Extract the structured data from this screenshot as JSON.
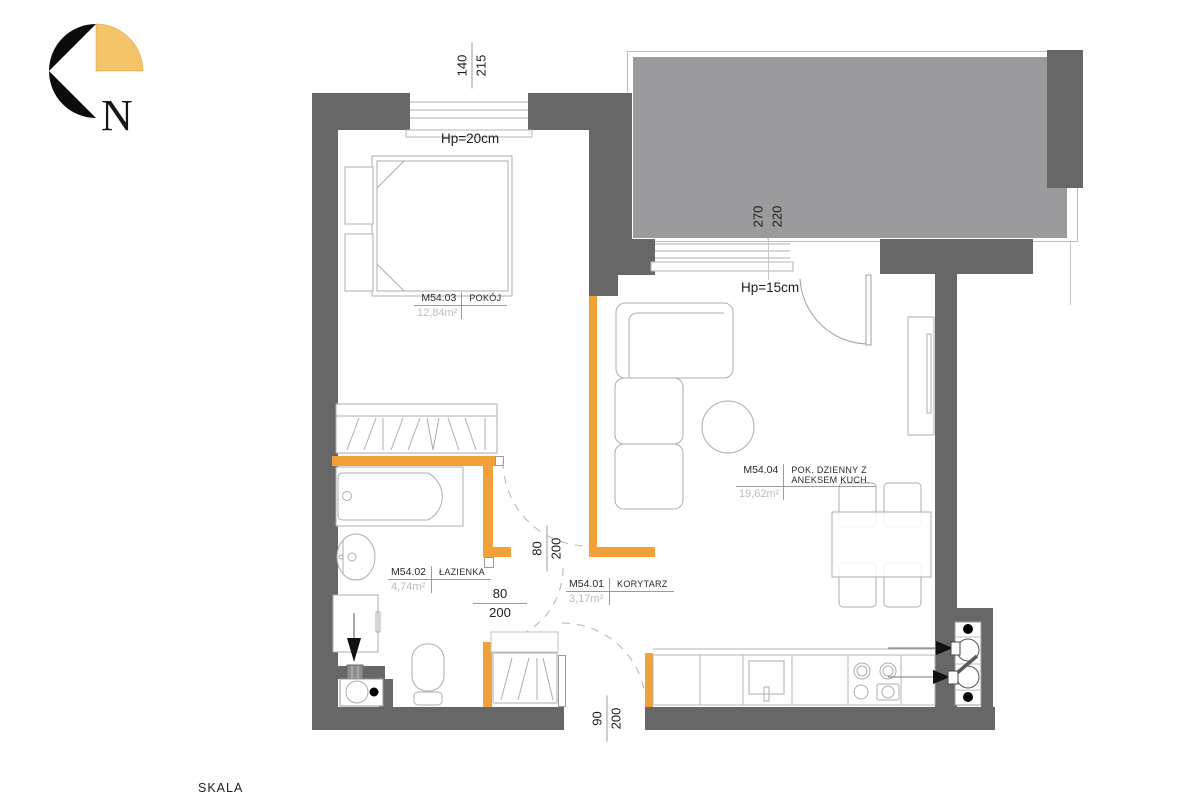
{
  "compass": {
    "north_label": "N"
  },
  "scale_label": "SKALA",
  "rooms": [
    {
      "code": "M54.03",
      "name": "POKÓJ",
      "area": "12,84m²"
    },
    {
      "code": "M54.02",
      "name": "ŁAZIENKA",
      "area": "4,74m²"
    },
    {
      "code": "M54.01",
      "name": "KORYTARZ",
      "area": "3,17m²"
    },
    {
      "code": "M54.04",
      "name": "POK. DZIENNY Z",
      "name2": "ANEKSEM KUCH.",
      "area": "19,62m²"
    }
  ],
  "sill_labels": {
    "bedroom": "Hp=20cm",
    "living": "Hp=15cm"
  },
  "dimensions": {
    "bedroom_window": {
      "top": "140",
      "bottom": "215"
    },
    "living_window": {
      "top": "270",
      "bottom": "220"
    },
    "bedroom_door": {
      "top": "80",
      "bottom": "200"
    },
    "bathroom_door": {
      "top": "80",
      "bottom": "200"
    },
    "entrance_door": {
      "top": "90",
      "bottom": "200"
    }
  },
  "colors": {
    "structural_wall": "#676767",
    "partition_wall": "#F2A13A",
    "balcony_slab": "#9B9B9D",
    "area_value_text": "#BCBCBC"
  }
}
